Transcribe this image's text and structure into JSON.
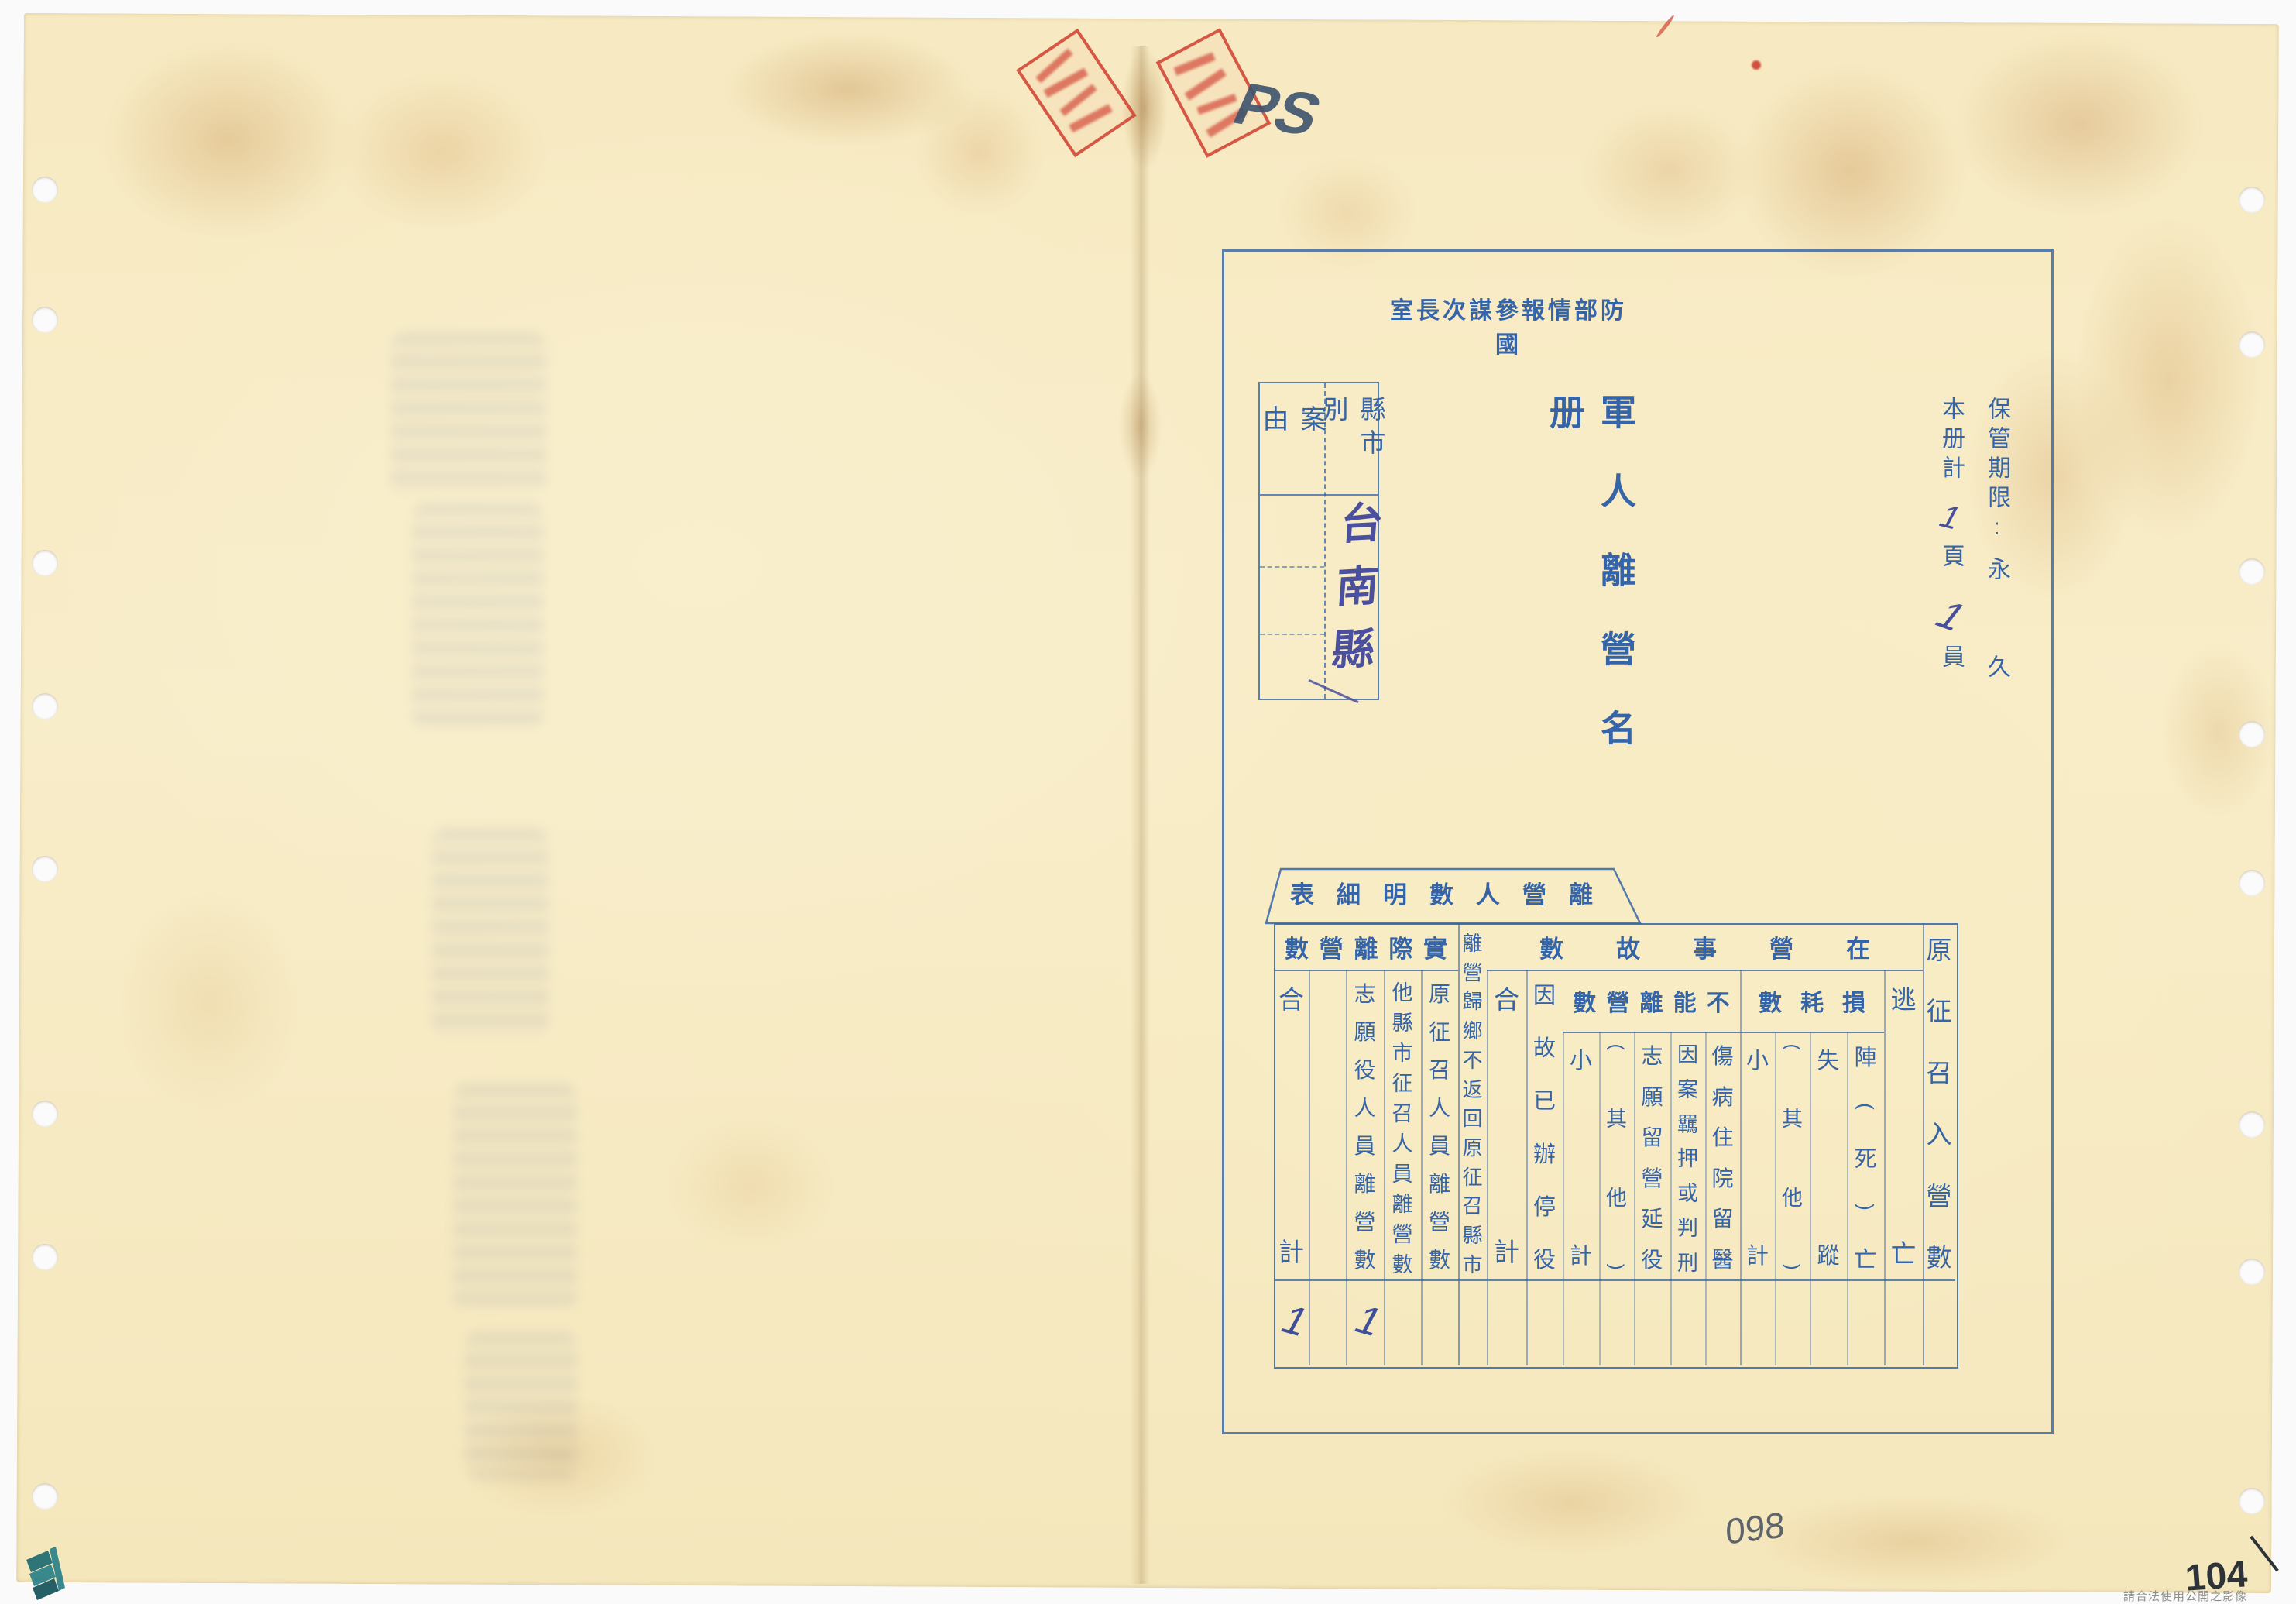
{
  "document": {
    "agency_title": {
      "text": "國防部情報參謀次長室",
      "display": "室長次謀參報情部防國"
    },
    "roster_title": {
      "text": "軍人離營名冊",
      "display": "軍人離營名册"
    },
    "retention": {
      "label": "保管期限:",
      "value": "永久",
      "value_char1": "永",
      "value_char2": "久"
    },
    "volume_line": {
      "lead": "本册計",
      "page_count": "1",
      "page_unit": "頁",
      "person_count": "1",
      "person_unit": "員"
    },
    "case_box": {
      "case_label": "案由",
      "case_value": "",
      "region_label": "縣市別",
      "region_value_handwritten": "台南縣"
    }
  },
  "table": {
    "title": {
      "text": "離營人數明細表",
      "display": "表細明數人營離"
    },
    "groups": [
      {
        "id": "actual",
        "text": "實際離營數",
        "display": "數營離際實"
      },
      {
        "id": "incamp",
        "text": "在營事故數",
        "display": "數故事營在"
      },
      {
        "id": "cannot",
        "text": "不能離營數",
        "display": "數營離能不"
      },
      {
        "id": "loss",
        "text": "損耗數",
        "display": "數耗損"
      }
    ],
    "columns_right_to_left": [
      {
        "id": "conscripted",
        "label": "原征召入營數",
        "group": null,
        "value": ""
      },
      {
        "id": "desertion",
        "label": "逃亡",
        "group": "incamp",
        "value": ""
      },
      {
        "id": "battle-death",
        "label": "陣(死)亡",
        "group": "loss",
        "value": ""
      },
      {
        "id": "missing",
        "label": "失蹤",
        "group": "loss",
        "value": ""
      },
      {
        "id": "loss-other",
        "label": "(其他)",
        "group": "loss",
        "value": ""
      },
      {
        "id": "loss-subtotal",
        "label": "小計",
        "group": "loss",
        "value": ""
      },
      {
        "id": "hospitalized",
        "label": "傷病住院留醫",
        "group": "cannot",
        "value": ""
      },
      {
        "id": "detained",
        "label": "因案羈押或判刑",
        "group": "cannot",
        "value": ""
      },
      {
        "id": "volunteer-stay",
        "label": "志願留營延役",
        "group": "cannot",
        "value": ""
      },
      {
        "id": "cannot-other",
        "label": "(其他)",
        "group": "cannot",
        "value": ""
      },
      {
        "id": "cannot-subtotal",
        "label": "小計",
        "group": "cannot",
        "value": ""
      },
      {
        "id": "suspended",
        "label": "因故已辦停役",
        "group": "incamp",
        "value": ""
      },
      {
        "id": "incamp-total",
        "label": "合計",
        "group": "incamp",
        "value": ""
      },
      {
        "id": "returned-home",
        "label": "離營歸鄉不返回原征召縣市",
        "group": null,
        "value": ""
      },
      {
        "id": "orig-conscript-leave",
        "label": "原征召人員離營數",
        "group": "actual",
        "value": ""
      },
      {
        "id": "other-county-leave",
        "label": "他縣市征召人員離營數",
        "group": "actual",
        "value": ""
      },
      {
        "id": "volunteer-leave",
        "label": "志願役人員離營數",
        "group": "actual",
        "value": "1"
      },
      {
        "id": "blank",
        "label": "",
        "group": "actual",
        "value": ""
      },
      {
        "id": "actual-total",
        "label": "合計",
        "group": "actual",
        "value": "1"
      }
    ]
  },
  "annotations": {
    "pencil_note_top": "PS",
    "pencil_number_bottom": "098",
    "pencil_number_corner": "104",
    "footer_notice": "請合法使用公開之影像",
    "stamps": [
      {
        "shape": "rectangle",
        "color": "red",
        "legible": false
      },
      {
        "shape": "rectangle",
        "color": "red",
        "legible": false
      }
    ]
  },
  "colors": {
    "print_blue": "#3565a8",
    "handwriting_ink": "#4a4f9e",
    "stamp_red": "#cf3e2f",
    "pencil_gray": "#55606e",
    "paper": "#f7eac2",
    "logo_teal": "#2a8088"
  }
}
